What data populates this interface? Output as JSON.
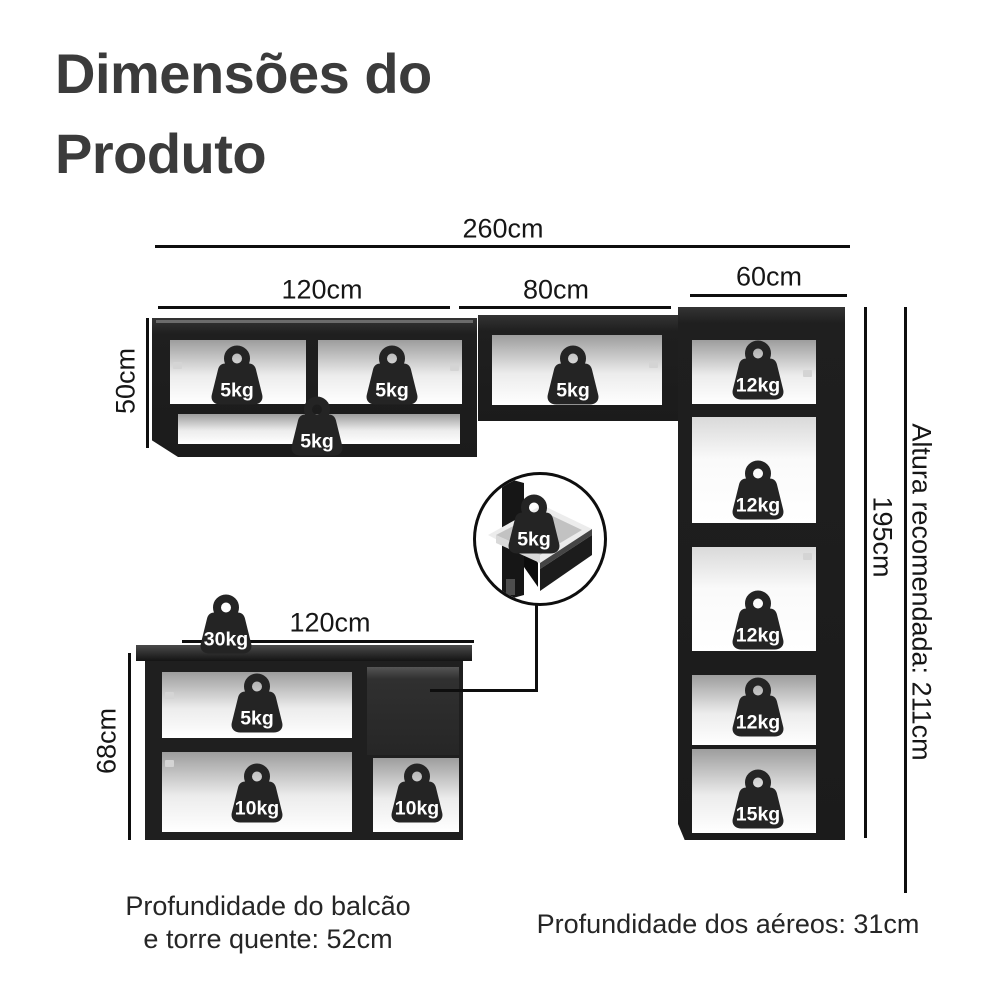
{
  "title": {
    "line1": "Dimensões do",
    "line2": "Produto"
  },
  "captions": {
    "balcao_line1": "Profundidade do balcão",
    "balcao_line2": "e torre quente: 52cm",
    "aereos": "Profundidade dos aéreos: 31cm"
  },
  "colors": {
    "cabinet": "#1f1f1f",
    "dimension_line": "#0e0e0e",
    "title_text": "#3b3b3b",
    "weight_icon": "#242424",
    "weight_text": "#ffffff"
  },
  "dimensions": [
    {
      "name": "total-width",
      "label": "260cm",
      "orient": "h",
      "x": 155,
      "y": 245,
      "len": 695,
      "label_x": 503,
      "label_y": 229
    },
    {
      "name": "aereo-120-width",
      "label": "120cm",
      "orient": "h",
      "x": 158,
      "y": 306,
      "len": 292,
      "label_x": 322,
      "label_y": 290
    },
    {
      "name": "aereo-80-width",
      "label": "80cm",
      "orient": "h",
      "x": 459,
      "y": 306,
      "len": 212,
      "label_x": 556,
      "label_y": 290
    },
    {
      "name": "tower-width",
      "label": "60cm",
      "orient": "h",
      "x": 690,
      "y": 294,
      "len": 157,
      "label_x": 769,
      "label_y": 277
    },
    {
      "name": "oven-width",
      "label": "57,4cm",
      "orient": "h",
      "x": 693,
      "y": 419,
      "len": 150,
      "label_x": 766,
      "label_y": 438
    },
    {
      "name": "aereo-50-height",
      "label": "50cm",
      "orient": "v",
      "x": 146,
      "y": 318,
      "len": 130,
      "label_x": 126,
      "label_y": 381,
      "rot": "ccw"
    },
    {
      "name": "aereo-33-height",
      "label": "33cm",
      "orient": "v",
      "x": 480,
      "y": 322,
      "len": 82,
      "label_x": 497,
      "label_y": 364,
      "rot": "ccw"
    },
    {
      "name": "oven-height",
      "label": "47,3cm",
      "orient": "v",
      "x": 696,
      "y": 420,
      "len": 101,
      "label_x": 714,
      "label_y": 480,
      "rot": "ccw"
    },
    {
      "name": "shelf-41-height",
      "label": "41cm",
      "orient": "v",
      "x": 696,
      "y": 547,
      "len": 101,
      "label_x": 714,
      "label_y": 598,
      "rot": "ccw"
    },
    {
      "name": "tower-height",
      "label": "195cm",
      "orient": "v",
      "x": 864,
      "y": 307,
      "len": 531,
      "label_x": 882,
      "label_y": 537,
      "rot": "cw"
    },
    {
      "name": "recommended-height",
      "label": "Altura recomendada: 211cm",
      "orient": "v",
      "x": 904,
      "y": 307,
      "len": 586,
      "label_x": 921,
      "label_y": 592,
      "rot": "cw"
    },
    {
      "name": "balcao-68-height",
      "label": "68cm",
      "orient": "v",
      "x": 128,
      "y": 653,
      "len": 187,
      "label_x": 107,
      "label_y": 741,
      "rot": "ccw"
    },
    {
      "name": "balcao-120-width",
      "label": "120cm",
      "orient": "h",
      "x": 182,
      "y": 640,
      "len": 292,
      "label_x": 330,
      "label_y": 623
    }
  ],
  "weights": [
    {
      "label": "5kg",
      "x": 237,
      "y": 379,
      "loc": "aereo-120-left"
    },
    {
      "label": "5kg",
      "x": 392,
      "y": 379,
      "loc": "aereo-120-right"
    },
    {
      "label": "5kg",
      "x": 317,
      "y": 430,
      "loc": "aereo-120-shelf"
    },
    {
      "label": "5kg",
      "x": 573,
      "y": 379,
      "loc": "aereo-80"
    },
    {
      "label": "12kg",
      "x": 758,
      "y": 374,
      "loc": "tower-top"
    },
    {
      "label": "12kg",
      "x": 758,
      "y": 494,
      "loc": "tower-oven"
    },
    {
      "label": "12kg",
      "x": 758,
      "y": 624,
      "loc": "tower-shelf-41"
    },
    {
      "label": "12kg",
      "x": 758,
      "y": 711,
      "loc": "tower-lower"
    },
    {
      "label": "15kg",
      "x": 758,
      "y": 803,
      "loc": "tower-bottom"
    },
    {
      "label": "30kg",
      "x": 226,
      "y": 628,
      "loc": "countertop"
    },
    {
      "label": "5kg",
      "x": 257,
      "y": 707,
      "loc": "balcao-upper"
    },
    {
      "label": "10kg",
      "x": 257,
      "y": 797,
      "loc": "balcao-lower"
    },
    {
      "label": "10kg",
      "x": 417,
      "y": 797,
      "loc": "balcao-right"
    },
    {
      "label": "5kg",
      "x": 534,
      "y": 528,
      "loc": "drawer-inset"
    }
  ]
}
